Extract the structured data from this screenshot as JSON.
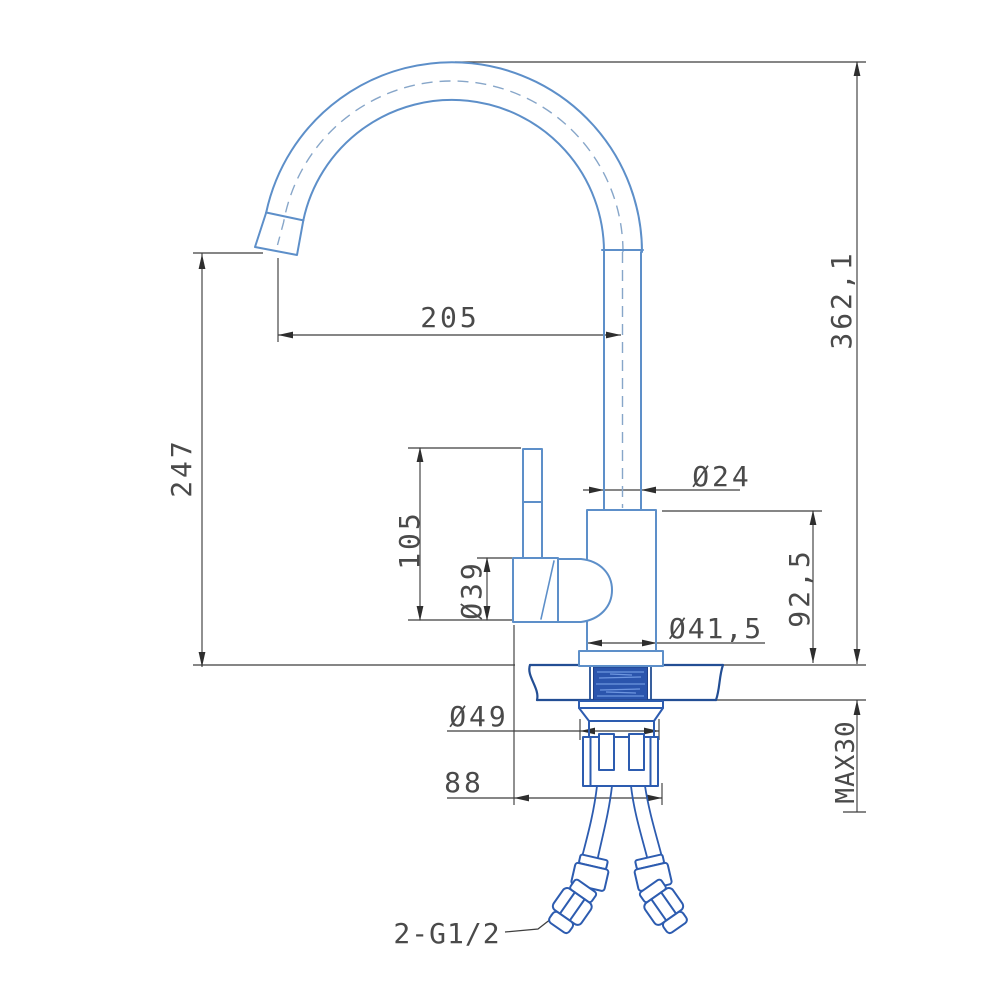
{
  "drawing": {
    "kind": "technical-dimension-drawing",
    "subject": "single-lever kitchen faucet, side elevation with installation dimensions",
    "units": "mm",
    "style": {
      "background": "#ffffff",
      "product_line_color": "#5d8fc9",
      "hardware_line_color": "#2d5cb0",
      "deck_line_color": "#234e94",
      "shank_fill_color": "#2b55ad",
      "dimension_line_color": "#3f3f3f",
      "text_color": "#4a4a4a"
    },
    "dimensions": {
      "spout_reach": "205",
      "spout_height": "247",
      "overall_height": "362,1",
      "spout_pipe_diameter": "Ø24",
      "handle_height": "105",
      "handle_diameter": "Ø39",
      "body_height": "92,5",
      "body_diameter": "Ø41,5",
      "base_diameter": "Ø49",
      "under_counter_depth": "88",
      "max_counter_thickness": "MAX30",
      "hose_thread_callout": "2-G1/2"
    }
  }
}
